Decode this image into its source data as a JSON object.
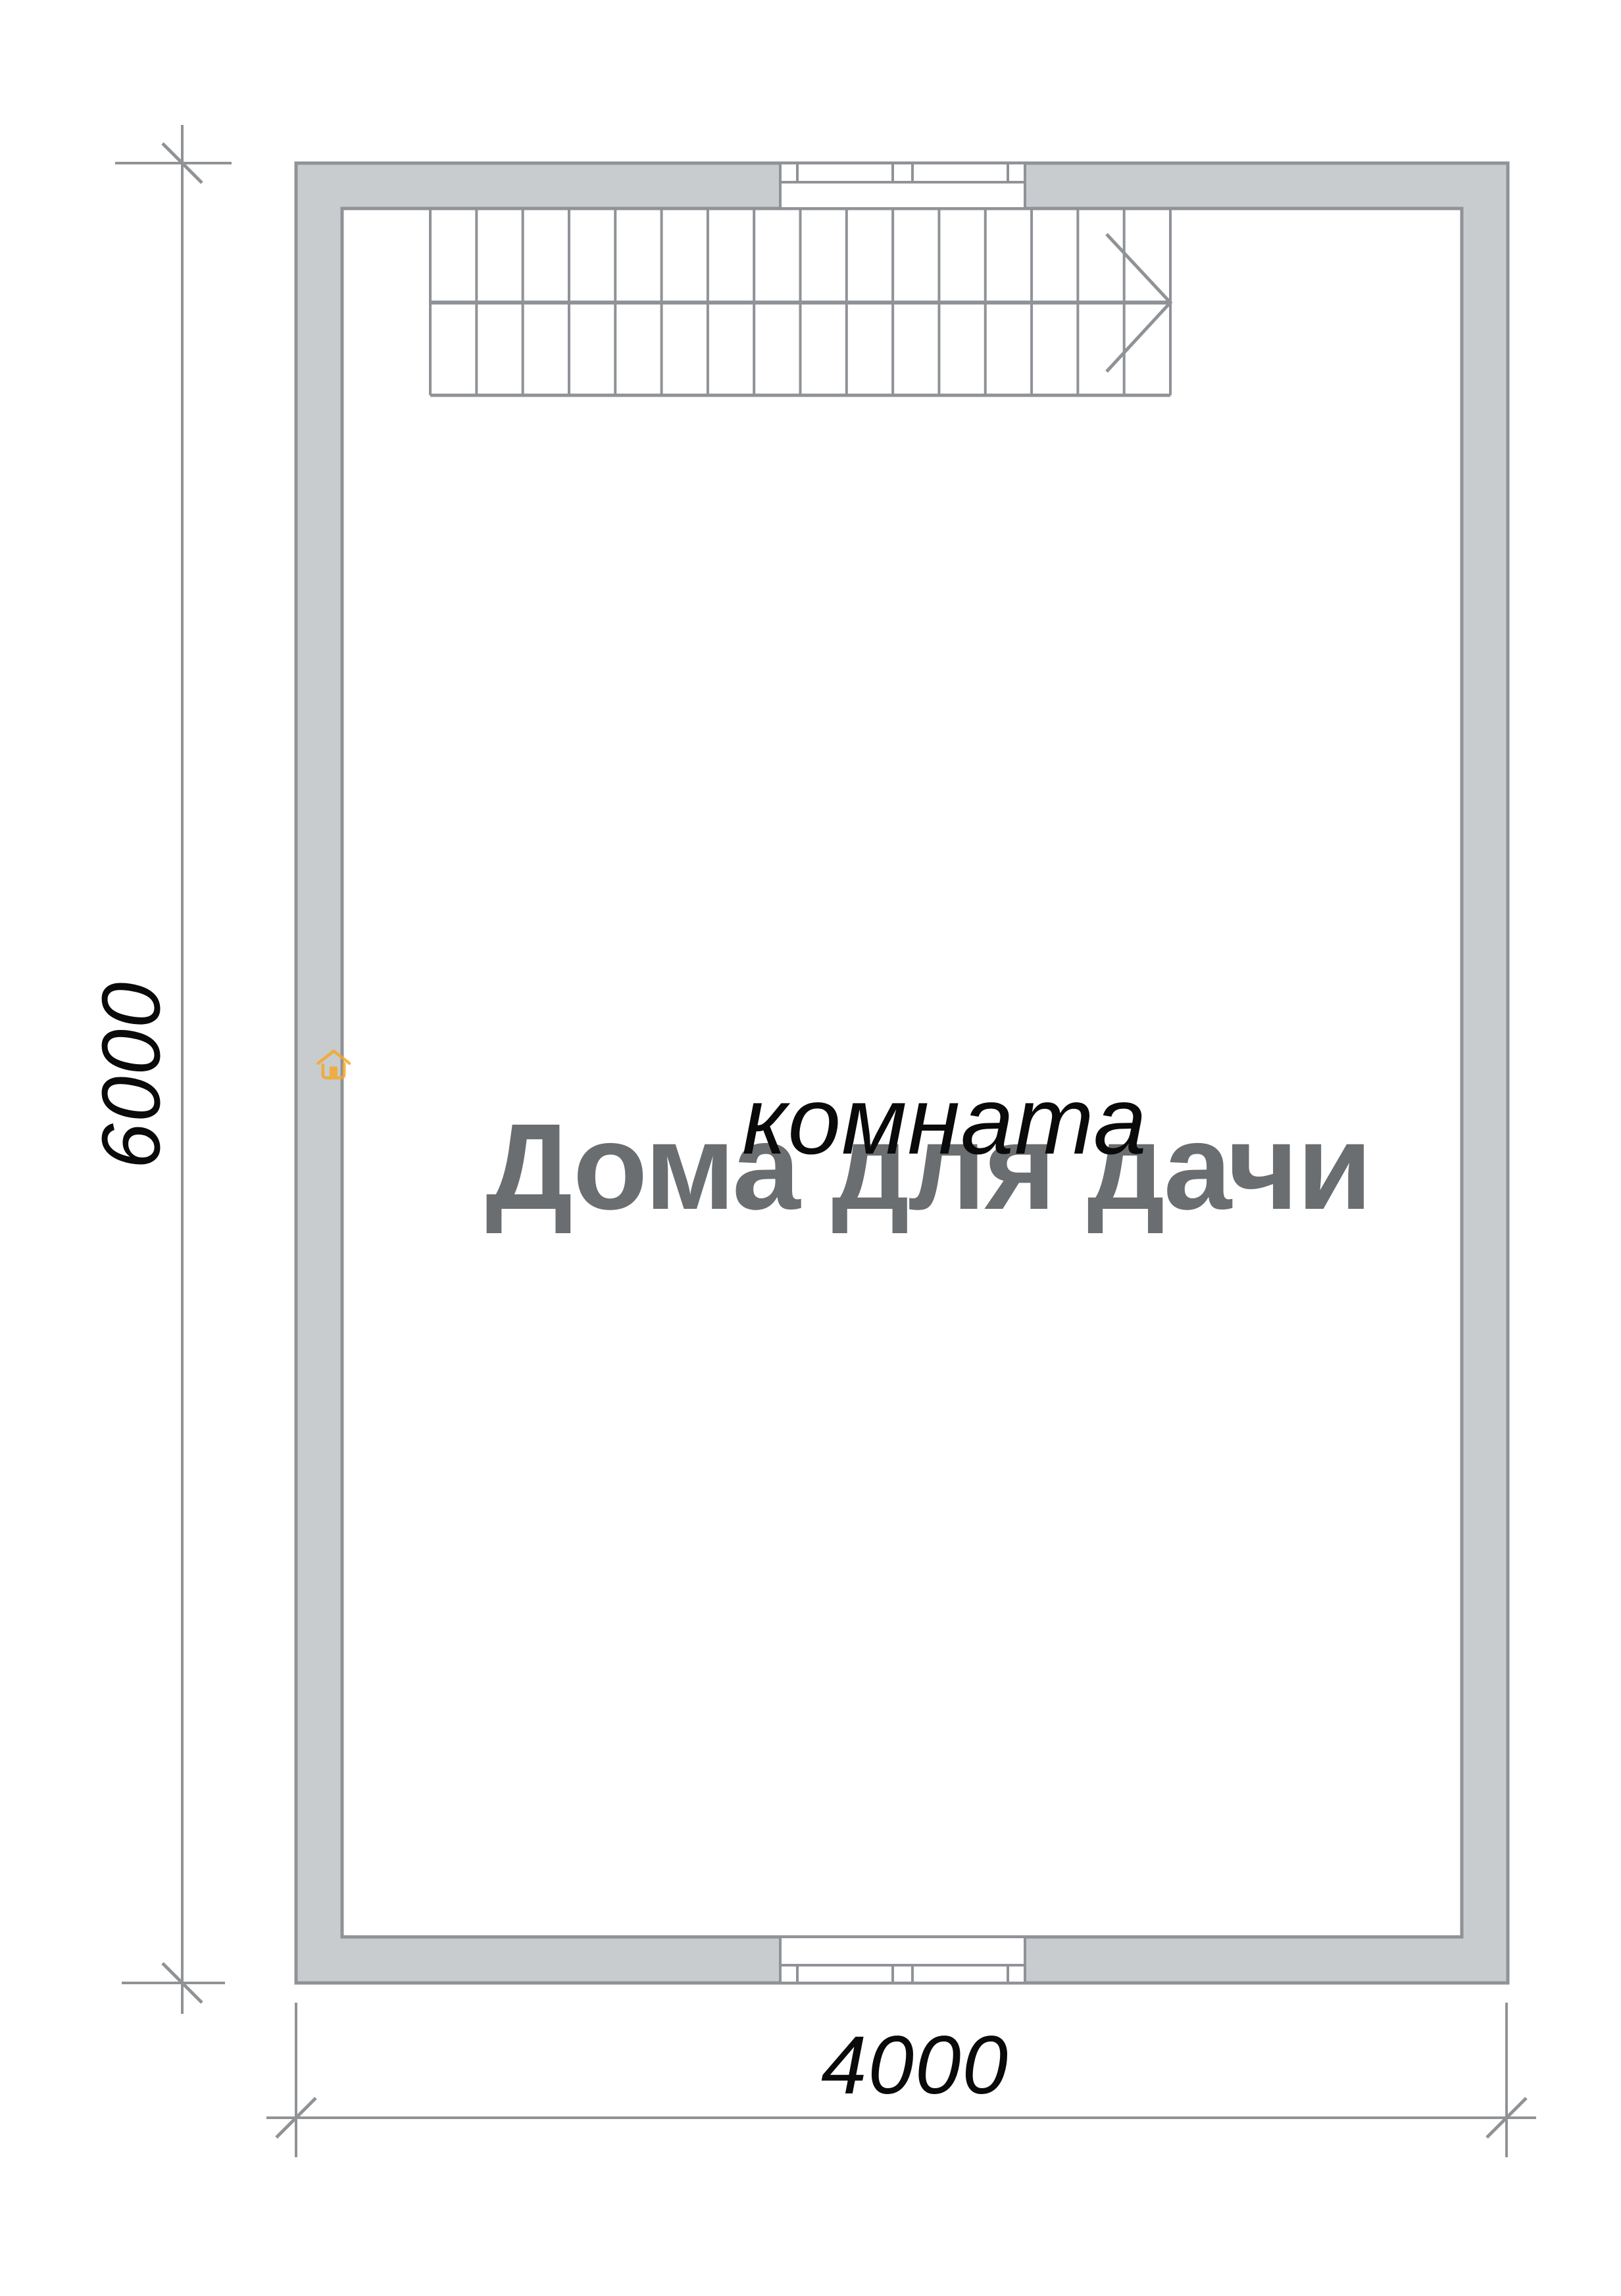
{
  "plan": {
    "room_label": "комната",
    "dim_height_label": "6000",
    "dim_width_label": "4000",
    "stairs": {
      "treads": 16,
      "arrow_direction": "right"
    },
    "window_count": 2
  },
  "watermark": {
    "brand": "Дома для дачи",
    "icon": "house-icon"
  },
  "colors": {
    "wall_fill": "#C9CCCE",
    "wall_line": "#8F9296",
    "stairs_line": "#8F9296",
    "dim_line": "#909396",
    "label_text": "#0a0a0a",
    "brand_gray": "#6B6E70",
    "brand_orange": "#F6A724"
  }
}
